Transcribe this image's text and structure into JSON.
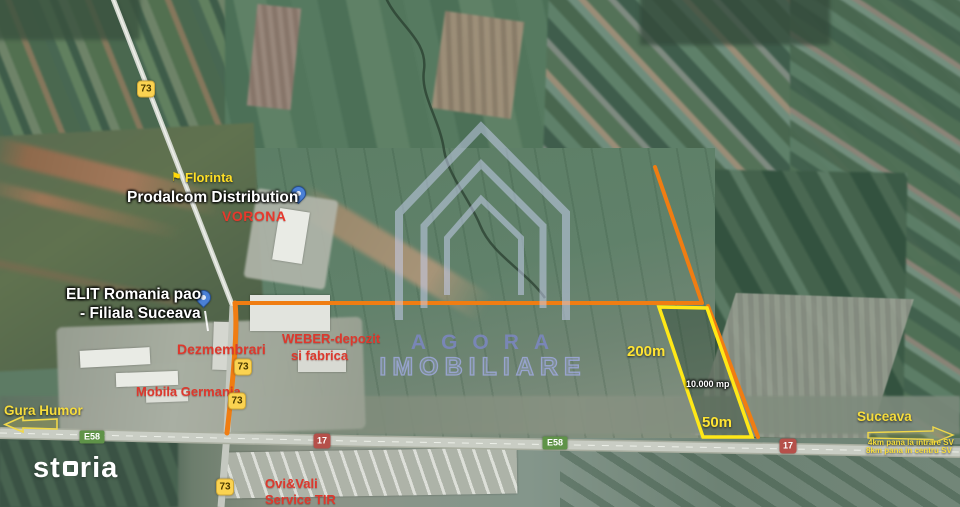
{
  "map": {
    "type": "satellite-annotated",
    "brand": {
      "agency_line1": "AGORA",
      "agency_line2": "IMOBILIARE",
      "portal": "storia",
      "portal_part1": "st",
      "portal_part2": "ria"
    },
    "places": {
      "florinta": "Florinta",
      "prodalcom": "Prodalcom Distribution",
      "vorona": "VORONA",
      "elit_line1": "ELIT Romania pao",
      "elit_line2": "- Filiala Suceava",
      "dezmembrari": "Dezmembrari",
      "weber_line1": "WEBER-depozit",
      "weber_line2": "si fabrica",
      "mobila_germania": "Mobila Germania",
      "gura_humor": "Gura Humor",
      "ovi_line1": "Ovi&Vali",
      "ovi_line2": "Service TIR",
      "suceava": "Suceava"
    },
    "plot": {
      "length": "200m",
      "width": "50m",
      "area": "10.000 mp"
    },
    "distances": {
      "line1": "4km pana la intrare SV",
      "line2": "8km pana in centru SV"
    },
    "road_shields": {
      "dn73": "73",
      "e58": "E58",
      "dn17": "17"
    },
    "colors": {
      "route_orange": "#f07d12",
      "plot_yellow": "#ffe817",
      "label_yellow": "#f6dc3c",
      "label_red": "#dd382d",
      "shield_yellow": "#fbd351",
      "shield_green": "#5f9348",
      "shield_red": "#b5504a",
      "pin_blue": "#4a80d6",
      "watermark_blue": "#9aa4d8"
    }
  }
}
